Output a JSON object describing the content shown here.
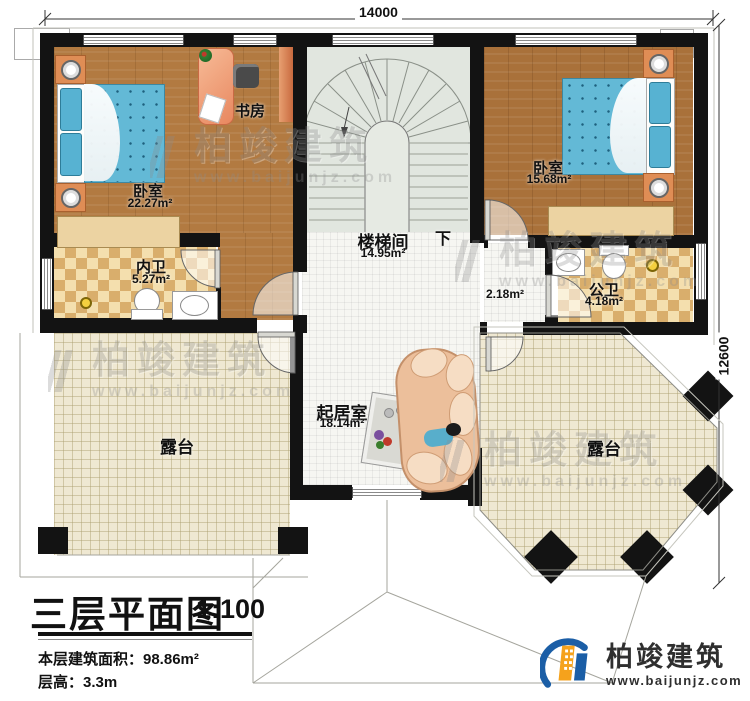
{
  "dimensions": {
    "width": "14000",
    "height": "12600"
  },
  "stairs": {
    "name": "楼梯间",
    "area": "14.95m²",
    "direction_label": "下"
  },
  "rooms": {
    "bedroom_left": {
      "name": "卧室",
      "area": "22.27m²"
    },
    "study": {
      "name": "书房"
    },
    "bedroom_right": {
      "name": "卧室",
      "area": "15.68m²"
    },
    "bath_inner": {
      "name": "内卫",
      "area": "5.27m²"
    },
    "bath_public": {
      "name": "公卫",
      "area": "4.18m²"
    },
    "hallway": {
      "area": "2.18m²"
    },
    "living_room": {
      "name": "起居室",
      "area": "18.14m²"
    },
    "terrace_left": {
      "name": "露台"
    },
    "terrace_right": {
      "name": "露台"
    }
  },
  "title_block": {
    "title": "三层平面图",
    "scale": "1:100",
    "floor_area": "本层建筑面积：98.86m²",
    "floor_height": "层高：3.3m"
  },
  "brand": {
    "name": "柏竣建筑",
    "website": "www.baijunjz.com"
  },
  "icons": {
    "brand_logo": "building-swoosh",
    "watermark_logo": "building-slashes"
  },
  "colors": {
    "wall": "#131313",
    "wood": "#b27a41",
    "bed": "#63b9d6",
    "bath_checker": "#d9ae6c",
    "terrace": "#efe8d2",
    "desk": "#ef9e78",
    "logo_blue": "#1b5ea6",
    "logo_orange": "#f5a21c"
  }
}
